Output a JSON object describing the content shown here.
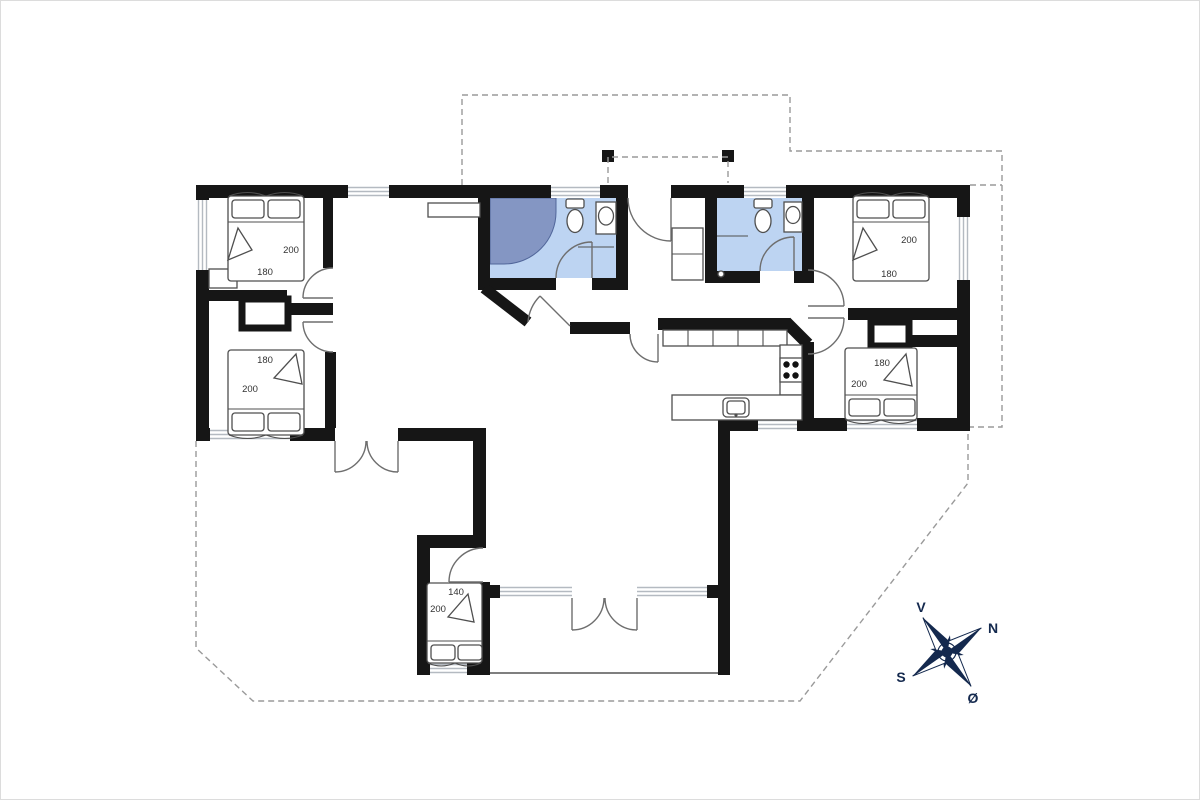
{
  "colors": {
    "wall": "#161616",
    "bathroom_floor": "#bdd4f2",
    "shower": "#8496c3",
    "window": "#b4bac1",
    "dashed_outline": "#9a9a9a",
    "furniture_line": "#4f4f4f",
    "compass": "#14294e"
  },
  "beds": [
    {
      "room": "bedroom-1",
      "length": "200",
      "width": "180"
    },
    {
      "room": "bedroom-2",
      "length": "200",
      "width": "180"
    },
    {
      "room": "bedroom-3",
      "length": "200",
      "width": "180"
    },
    {
      "room": "bedroom-4",
      "length": "200",
      "width": "180"
    },
    {
      "room": "bedroom-5",
      "length": "200",
      "width": "140"
    }
  ],
  "compass": {
    "west": "V",
    "north": "N",
    "south": "S",
    "east": "Ø"
  }
}
